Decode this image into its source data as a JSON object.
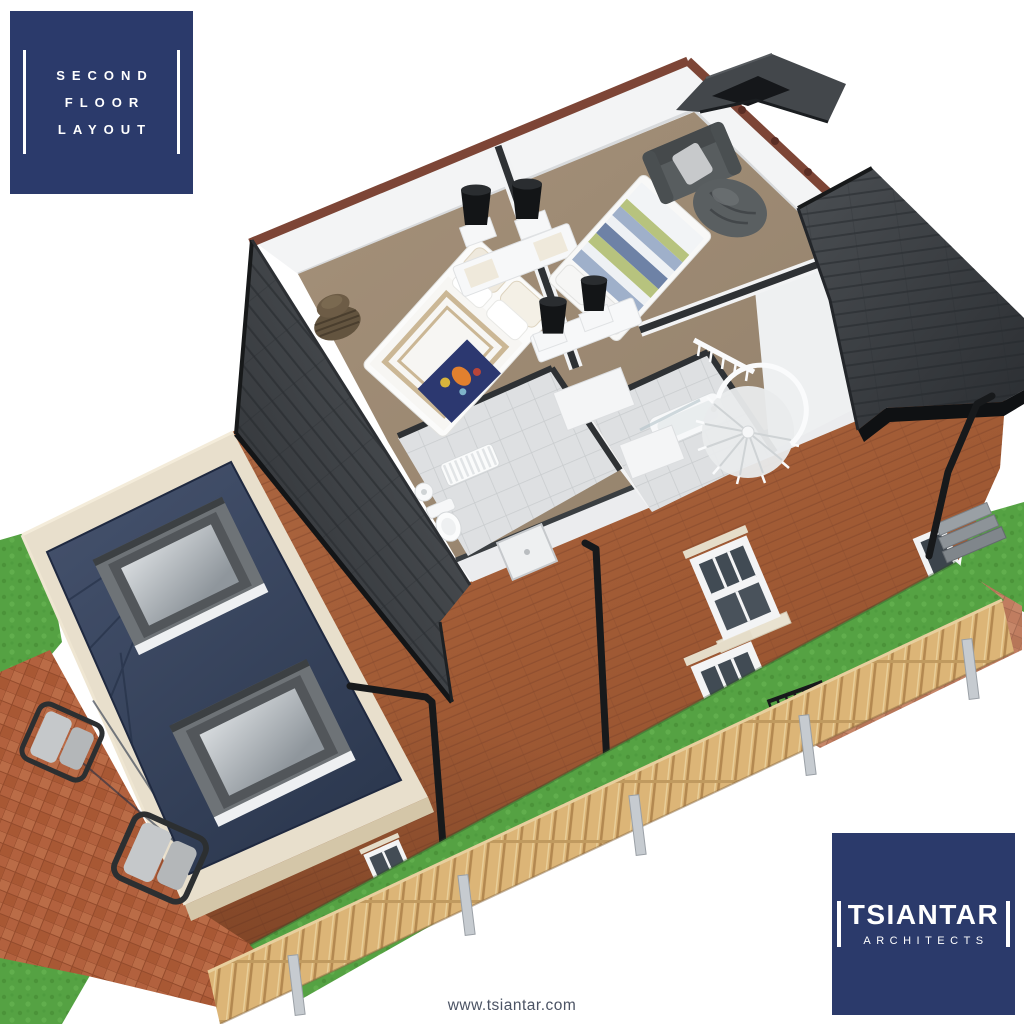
{
  "title_badge": {
    "lines": [
      "SECOND",
      "FLOOR",
      "LAYOUT"
    ]
  },
  "logo_badge": {
    "company": "TSIANTAR",
    "tagline": "ARCHITECTS"
  },
  "footer": {
    "website": "www.tsiantar.com"
  },
  "palette": {
    "brand_navy": "#2b3a6b",
    "badge_text": "#ffffff",
    "url_text": "#4b5364",
    "roof_slate": "#3c4044",
    "brick_red": "#a65f3d",
    "patio_brick": "#b2613e",
    "carpet_taupe": "#9d8a73",
    "extension_roof_navy": "#36425c",
    "parapet_cream": "#e8dfcc",
    "grass_green": "#55a243",
    "fence_wood": "#dbb476",
    "wall_white": "#f3f4f5"
  },
  "scene": {
    "type": "3d-cutaway-floor-plan-render",
    "elements": [
      "pitched-roof",
      "hip-roof-wing",
      "brick-facade",
      "sash-windows",
      "downpipes",
      "flat-roof-extension",
      "roof-skylights",
      "patio-with-chairs",
      "garden-fence",
      "bedroom-1-double-bed",
      "bedroom-2-double-bed",
      "armchair",
      "bean-bag",
      "bathroom",
      "shower-room",
      "spiral-staircase",
      "radiator",
      "toilet",
      "house-plant"
    ]
  }
}
